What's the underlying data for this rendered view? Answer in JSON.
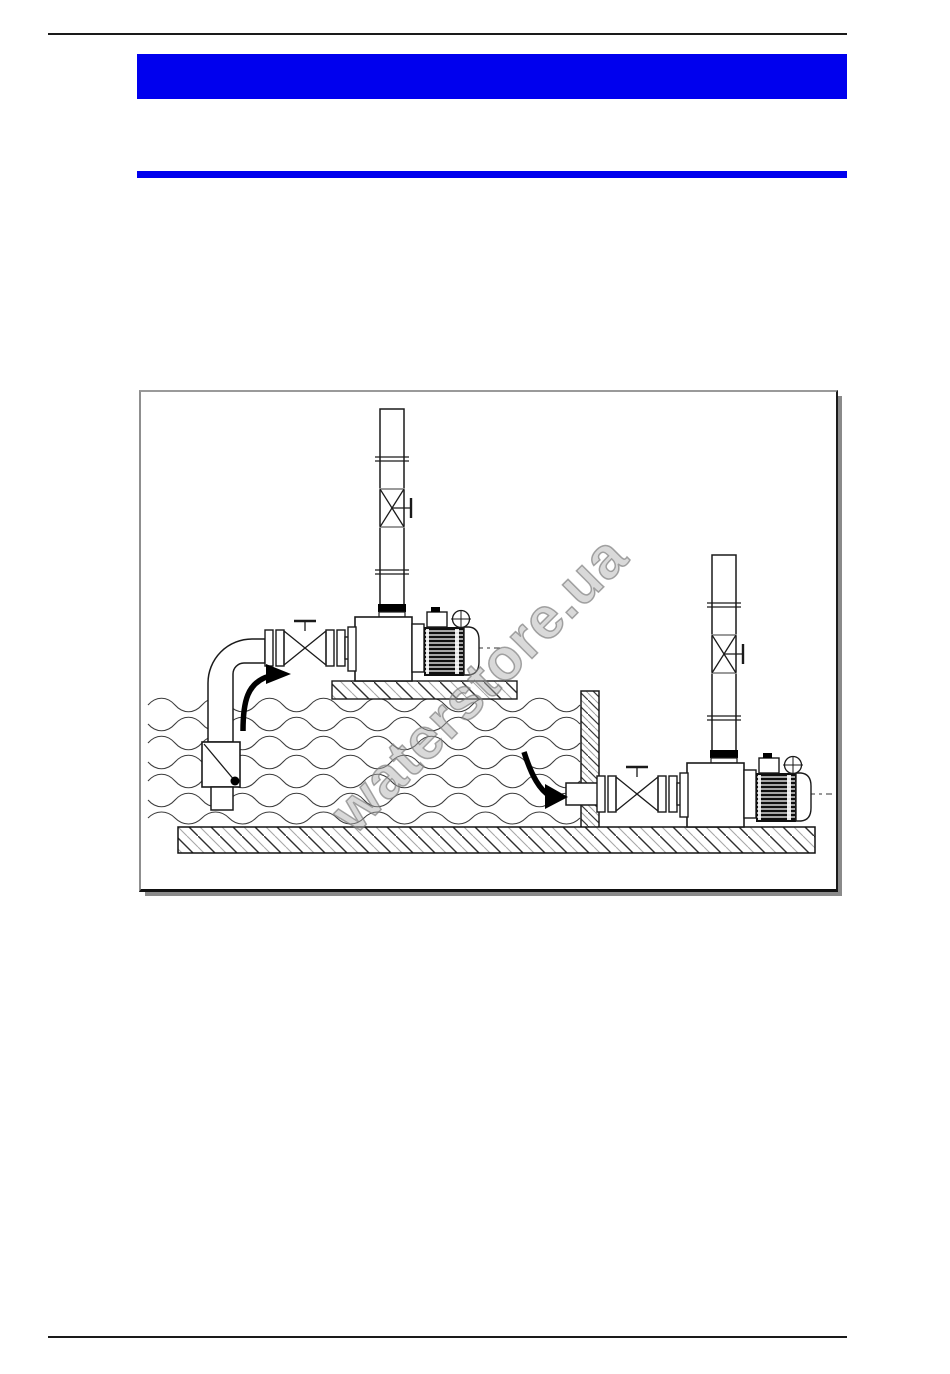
{
  "page": {
    "background": "#ffffff"
  },
  "header": {
    "title_banner": {
      "text": "",
      "color": "#0000ee"
    },
    "section_bar": {
      "color": "#0000ee"
    }
  },
  "rules": {
    "color": "#1a1a1a"
  },
  "figure": {
    "watermark": {
      "text": "waterstore.ua",
      "color": "#9a9a9a"
    },
    "frame_border_color": "#9a9a9a",
    "frame_shadow_color": "#8a8a8a",
    "line_color": "#1a1a1a",
    "hatch_dark": "#2f2f2f",
    "hatch_light": "#a8a8a8",
    "components": {
      "left_installation": "pump above water level with foot valve and suction lift",
      "right_installation": "pump below water level with flooded suction through wall",
      "water": "wavy water surface pattern in tank",
      "floor": "hatched ground slab",
      "wall": "hatched tank wall",
      "flow_arrows": "black curved flow-direction arrows"
    }
  }
}
